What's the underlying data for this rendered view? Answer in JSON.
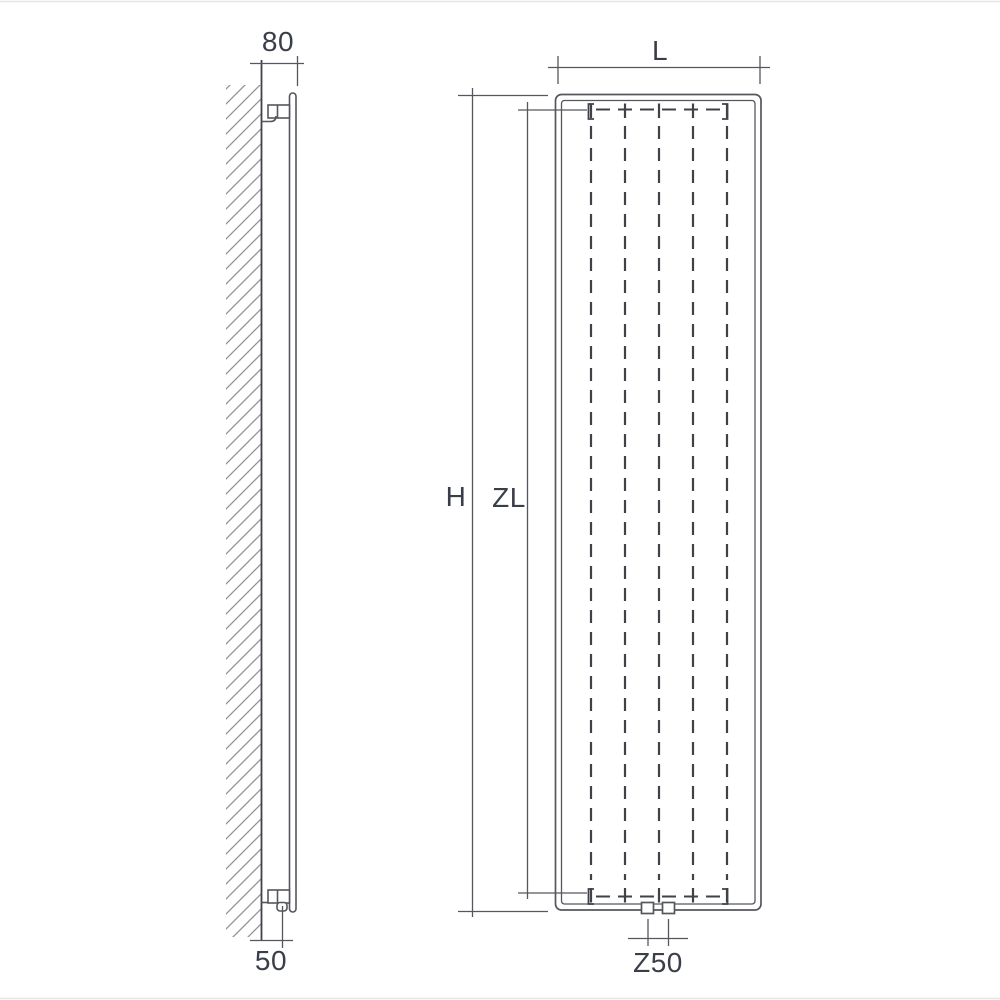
{
  "diagram": {
    "kind": "radiator-dimension-drawing",
    "side_view": {
      "depth_label": "80",
      "connection_offset_label": "50"
    },
    "front_view": {
      "width_label": "L",
      "height_label": "H",
      "element_height_label": "ZL",
      "connection_spacing_label": "Z50"
    },
    "colors": {
      "line": "#54575d",
      "line_dark": "#3f4248",
      "hatch": "#8f9297",
      "text": "#3a3e49",
      "background": "#ffffff",
      "page_rule": "#e4e5e7"
    }
  }
}
